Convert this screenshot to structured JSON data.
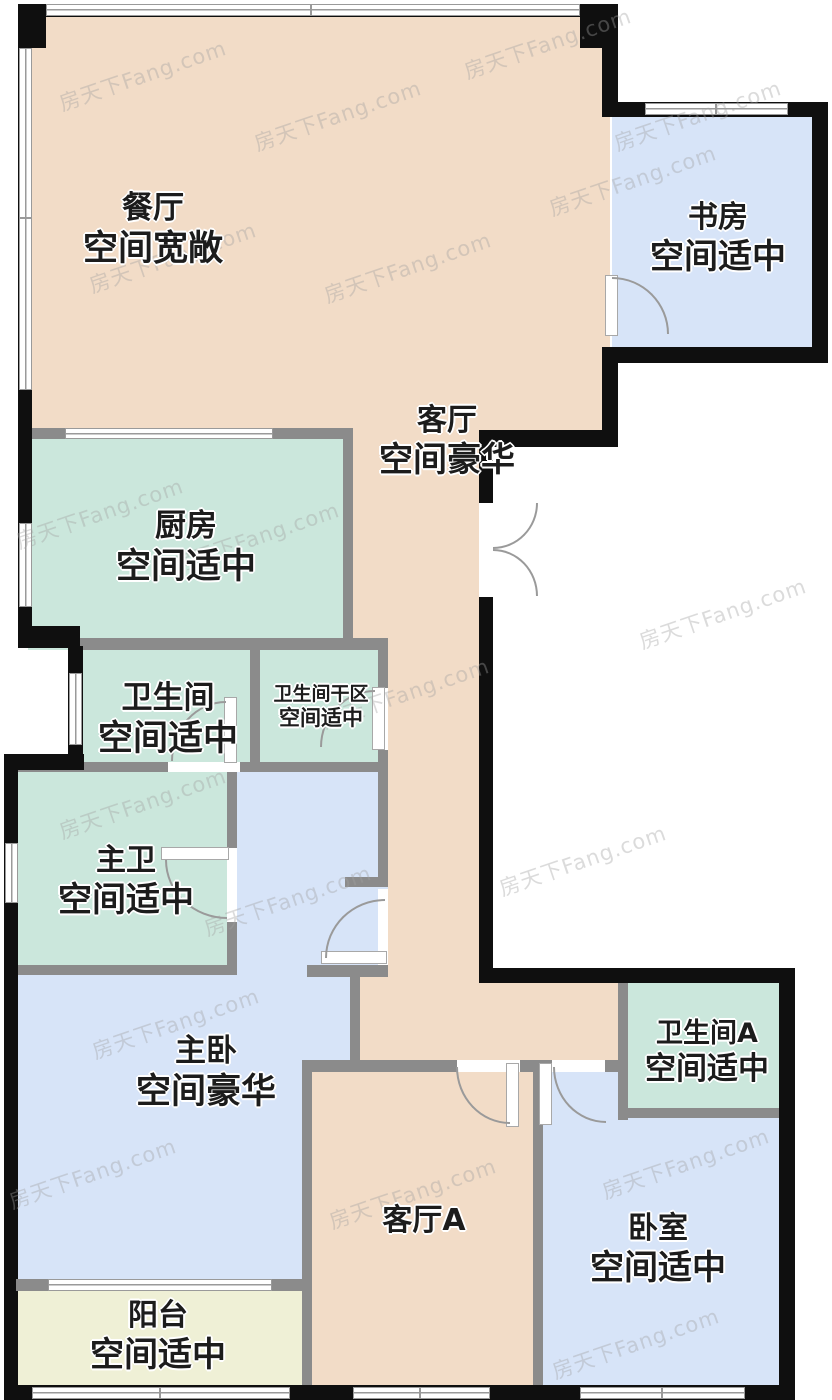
{
  "title": "户型图",
  "watermark": {
    "text": "房天下Fang.com"
  },
  "colors": {
    "living_area": "#f2dcc7",
    "bedroom_area": "#d7e4f8",
    "bathroom_area": "#cbe7dc",
    "balcony_area": "#eff0d6",
    "exterior_wall": "#0f0f0f",
    "interior_wall": "#8b8b8b",
    "label_text": "#1c1c1c"
  },
  "rooms": [
    {
      "id": "dining",
      "name": "餐厅",
      "grade": "空间宽敞"
    },
    {
      "id": "study",
      "name": "书房",
      "grade": "空间适中"
    },
    {
      "id": "living",
      "name": "客厅",
      "grade": "空间豪华"
    },
    {
      "id": "kitchen",
      "name": "厨房",
      "grade": "空间适中"
    },
    {
      "id": "bathroom",
      "name": "卫生间",
      "grade": "空间适中"
    },
    {
      "id": "bathroom-dry",
      "name": "卫生间干区",
      "grade": "空间适中"
    },
    {
      "id": "master-bathroom",
      "name": "主卫",
      "grade": "空间适中"
    },
    {
      "id": "master-bedroom",
      "name": "主卧",
      "grade": "空间豪华"
    },
    {
      "id": "bathroom-a",
      "name": "卫生间A",
      "grade": "空间适中"
    },
    {
      "id": "living-a",
      "name": "客厅A",
      "grade": ""
    },
    {
      "id": "bedroom",
      "name": "卧室",
      "grade": "空间适中"
    },
    {
      "id": "balcony",
      "name": "阳台",
      "grade": "空间适中"
    }
  ]
}
